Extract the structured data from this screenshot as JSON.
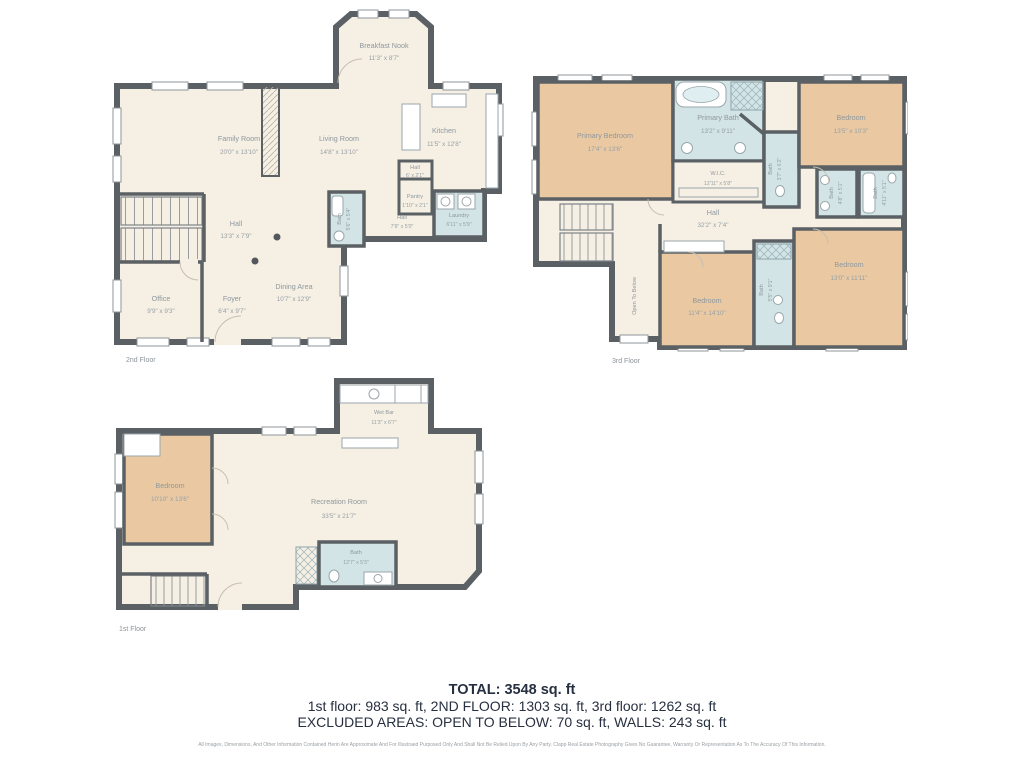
{
  "colors": {
    "wall": "#5b6064",
    "floor_fill": "#f6efe4",
    "bedroom_fill": "#eac9a2",
    "bath_fill": "#d2e4e6",
    "room_label": "#8e989e",
    "caption": "#8c9399",
    "summary_text": "#273040",
    "disclaimer_text": "#9aa0a5"
  },
  "floors": {
    "f2": {
      "caption": "2nd Floor",
      "rooms": {
        "breakfast_nook": {
          "name": "Breakfast Nook",
          "dims": "11'3\" x 8'7\""
        },
        "family_room": {
          "name": "Family Room",
          "dims": "20'0\" x 13'10\""
        },
        "living_room": {
          "name": "Living Room",
          "dims": "14'8\" x 13'10\""
        },
        "kitchen": {
          "name": "Kitchen",
          "dims": "11'5\" x 12'8\""
        },
        "hall_upper": {
          "name": "Hall",
          "dims": "6' x 2'1\""
        },
        "pantry": {
          "name": "Pantry",
          "dims": "1'10\" x 2'1\""
        },
        "hall_mid": {
          "name": "Hall",
          "dims": "7'9\" x 5'0\""
        },
        "laundry": {
          "name": "Laundry",
          "dims": "6'11\" x 5'9\""
        },
        "bath": {
          "name": "Bath",
          "dims": "5'6\" x 5'4\""
        },
        "hall_main": {
          "name": "Hall",
          "dims": "13'3\" x 7'9\""
        },
        "office": {
          "name": "Office",
          "dims": "9'9\" x 9'3\""
        },
        "foyer": {
          "name": "Foyer",
          "dims": "6'4\" x 9'7\""
        },
        "dining": {
          "name": "Dining Area",
          "dims": "10'7\" x 12'9\""
        }
      }
    },
    "f3": {
      "caption": "3rd Floor",
      "rooms": {
        "primary_bedroom": {
          "name": "Primary Bedroom",
          "dims": "17'4\" x 13'6\""
        },
        "primary_bath": {
          "name": "Primary Bath",
          "dims": "13'2\" x 9'11\""
        },
        "bedroom_tr": {
          "name": "Bedroom",
          "dims": "13'5\" x 10'3\""
        },
        "bath_small": {
          "name": "Bath",
          "dims": "3'7\" x 6'2\""
        },
        "wic": {
          "name": "W.I.C.",
          "dims": "12'11\" x 5'8\""
        },
        "bath_left": {
          "name": "Bath",
          "dims": "4'8\" x 5'1\""
        },
        "bath_right": {
          "name": "Bath",
          "dims": "4'11\" x 5'1\""
        },
        "hall": {
          "name": "Hall",
          "dims": "32'2\" x 7'4\""
        },
        "open_below": {
          "name": "Open To Below"
        },
        "bedroom_bm": {
          "name": "Bedroom",
          "dims": "11'4\" x 14'10\""
        },
        "bath_mid": {
          "name": "Bath",
          "dims": "5'5\" x 9'1\""
        },
        "bedroom_br": {
          "name": "Bedroom",
          "dims": "13'0\" x 11'11\""
        }
      }
    },
    "f1": {
      "caption": "1st Floor",
      "rooms": {
        "wet_bar": {
          "name": "Wet Bar",
          "dims": "11'3\" x 6'7\""
        },
        "bedroom": {
          "name": "Bedroom",
          "dims": "10'10\" x 13'6\""
        },
        "recreation": {
          "name": "Recreation Room",
          "dims": "33'5\" x 21'7\""
        },
        "bath": {
          "name": "Bath",
          "dims": "12'7\" x 5'3\""
        }
      }
    }
  },
  "summary": {
    "total": "TOTAL: 3548 sq. ft",
    "floors_line": "1st floor: 983 sq. ft, 2ND FLOOR: 1303 sq. ft, 3rd floor: 1262 sq. ft",
    "excluded_line": "EXCLUDED AREAS: OPEN TO BELOW: 70 sq. ft, WALLS: 243 sq. ft"
  },
  "disclaimer": "All Images, Dimensions, And Other Information Contained Herin Are Approximate And For Illustraed Purposed Only And Shall Not Be Relied Upon By Any Party. Clapp Real Estate Photography Gives No Guarantee, Warranty Or Representation As To The Accuracy Of This Information."
}
